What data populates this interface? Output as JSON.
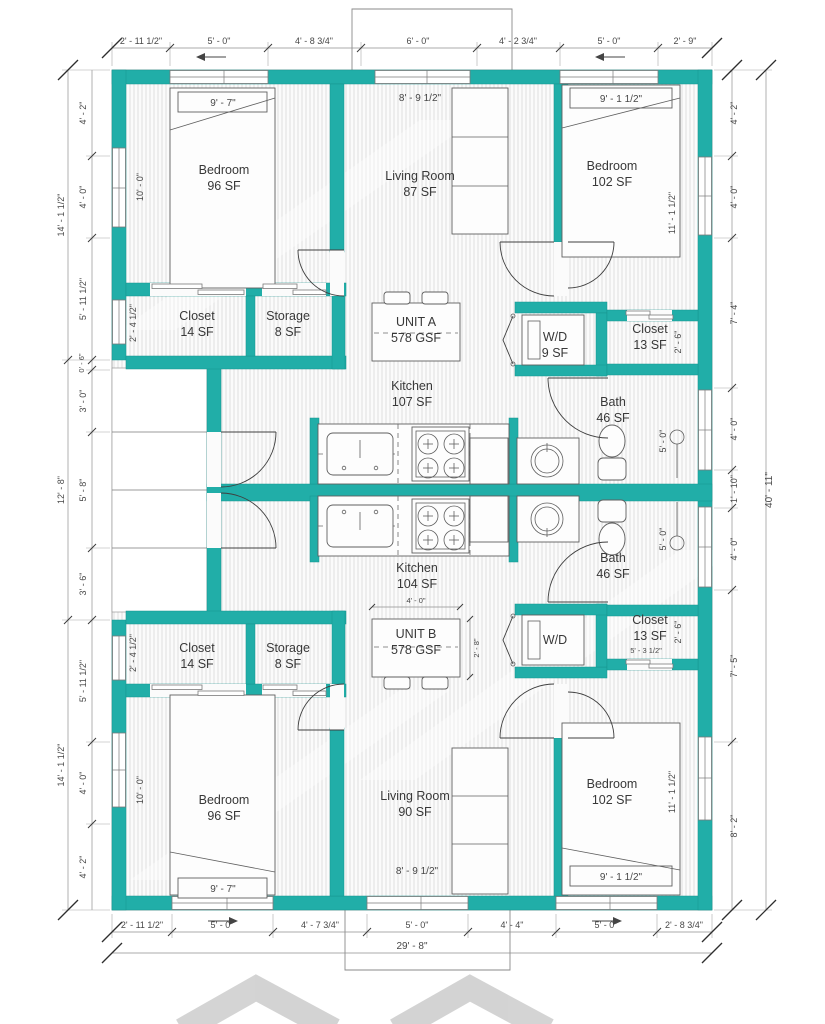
{
  "colors": {
    "wall_teal": "#21aea8",
    "hatch_gray": "#d9d9d9",
    "dim_text": "#474747"
  },
  "rooms": {
    "a": {
      "bedroom_l": {
        "name": "Bedroom",
        "area": "96 SF"
      },
      "living": {
        "name": "Living Room",
        "area": "87 SF"
      },
      "bedroom_r": {
        "name": "Bedroom",
        "area": "102 SF"
      },
      "closet_l": {
        "name": "Closet",
        "area": "14 SF"
      },
      "storage": {
        "name": "Storage",
        "area": "8 SF"
      },
      "unit": {
        "name": "UNIT A",
        "area": "578 GSF"
      },
      "wd": {
        "name": "W/D",
        "area": "9 SF"
      },
      "closet_r": {
        "name": "Closet",
        "area": "13 SF"
      },
      "kitchen": {
        "name": "Kitchen",
        "area": "107 SF"
      },
      "bath": {
        "name": "Bath",
        "area": "46 SF"
      }
    },
    "b": {
      "kitchen": {
        "name": "Kitchen",
        "area": "104 SF"
      },
      "unit": {
        "name": "UNIT B",
        "area": "578 GSF"
      },
      "wd": {
        "name": "W/D"
      },
      "closet_r": {
        "name": "Closet",
        "area": "13 SF"
      },
      "bath": {
        "name": "Bath",
        "area": "46 SF"
      },
      "closet_l": {
        "name": "Closet",
        "area": "14 SF"
      },
      "storage": {
        "name": "Storage",
        "area": "8 SF"
      },
      "bedroom_l": {
        "name": "Bedroom",
        "area": "96 SF"
      },
      "living": {
        "name": "Living Room",
        "area": "90 SF"
      },
      "bedroom_r": {
        "name": "Bedroom",
        "area": "102 SF"
      }
    }
  },
  "dims": {
    "top": [
      "2' - 11 1/2\"",
      "5' - 0\"",
      "4' - 8 3/4\"",
      "6' - 0\"",
      "4' - 2 3/4\"",
      "5' - 0\"",
      "2' - 9\""
    ],
    "bottom": [
      "2' - 11 1/2\"",
      "5' - 0\"",
      "4' - 7 3/4\"",
      "5' - 0\"",
      "4' - 4\"",
      "5' - 0\"",
      "2' - 8 3/4\""
    ],
    "bottom_total": "29' - 8\"",
    "left_outer": [
      "14' - 1 1/2\"",
      "12' - 8\"",
      "14' - 1 1/2\""
    ],
    "left_inner": [
      "4' - 2\"",
      "4' - 0\"",
      "5' - 11 1/2\"",
      "0' - 6\"",
      "3' - 0\"",
      "5' - 8\"",
      "3' - 6\"",
      "5' - 11 1/2\"",
      "4' - 0\"",
      "4' - 2\""
    ],
    "right_outer": "40' - 11\"",
    "right_inner": [
      "4' - 2\"",
      "4' - 0\"",
      "7' - 4\"",
      "4' - 0\"",
      "1' - 10\"",
      "4' - 0\"",
      "7' - 5\"",
      "8' - 2\""
    ],
    "interior": {
      "bed_a_l": "9' - 7\"",
      "living_a": "8' - 9 1/2\"",
      "bed_a_r": "9' - 1 1/2\"",
      "bed_b_l": "9' - 7\"",
      "living_b": "8' - 9 1/2\"",
      "bed_b_r": "9' - 1 1/2\"",
      "bedroom_l_width": "10' - 0\"",
      "bedroom_r_width": "11' - 1 1/2\"",
      "closet_l_depth": "2' - 4 1/2\"",
      "closet_r_depth": "2' - 6\"",
      "closet_b_width": "5' - 3 1/2\"",
      "bath_len": "5' - 0\"",
      "table_b_w": "4' - 0\"",
      "table_b_h": "2' - 8\""
    }
  }
}
